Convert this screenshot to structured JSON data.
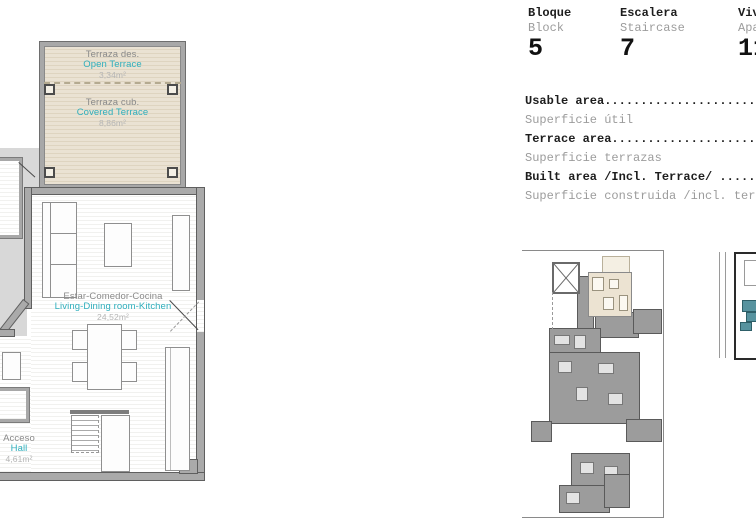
{
  "plan": {
    "terrace_open": {
      "es": "Terraza des.",
      "en": "Open Terrace",
      "area": "3,34m²"
    },
    "terrace_covered": {
      "es": "Terraza cub.",
      "en": "Covered Terrace",
      "area": "8,86m²"
    },
    "living": {
      "es": "Estar-Comedor-Cocina",
      "en": "Living-Dining room-Kitchen",
      "area": "24,52m²"
    },
    "hall": {
      "es": "Acceso",
      "en": "Hall",
      "area": "4,61m²"
    }
  },
  "header": {
    "columns": [
      {
        "es": "Bloque",
        "en": "Block",
        "value": "5"
      },
      {
        "es": "Escalera",
        "en": "Staircase",
        "value": "7"
      },
      {
        "es": "Vivienda",
        "en": "Apartment",
        "value": "11"
      }
    ]
  },
  "areas": {
    "rows": [
      {
        "en": "Usable area..........................",
        "es": "Superficie útil"
      },
      {
        "en": "Terrace area.........................",
        "es": "Superficie terrazas"
      },
      {
        "en": "Built area /Incl. Terrace/ ..........",
        "es": "Superficie construida /incl. terraza/"
      }
    ]
  },
  "colors": {
    "accent_teal": "#2fafbd",
    "wall_gray": "#aaaaaa",
    "terrace_beige": "#eae2d3",
    "exterior_gray": "#d8d8d8",
    "highlight_unit": "#ece3d2"
  }
}
